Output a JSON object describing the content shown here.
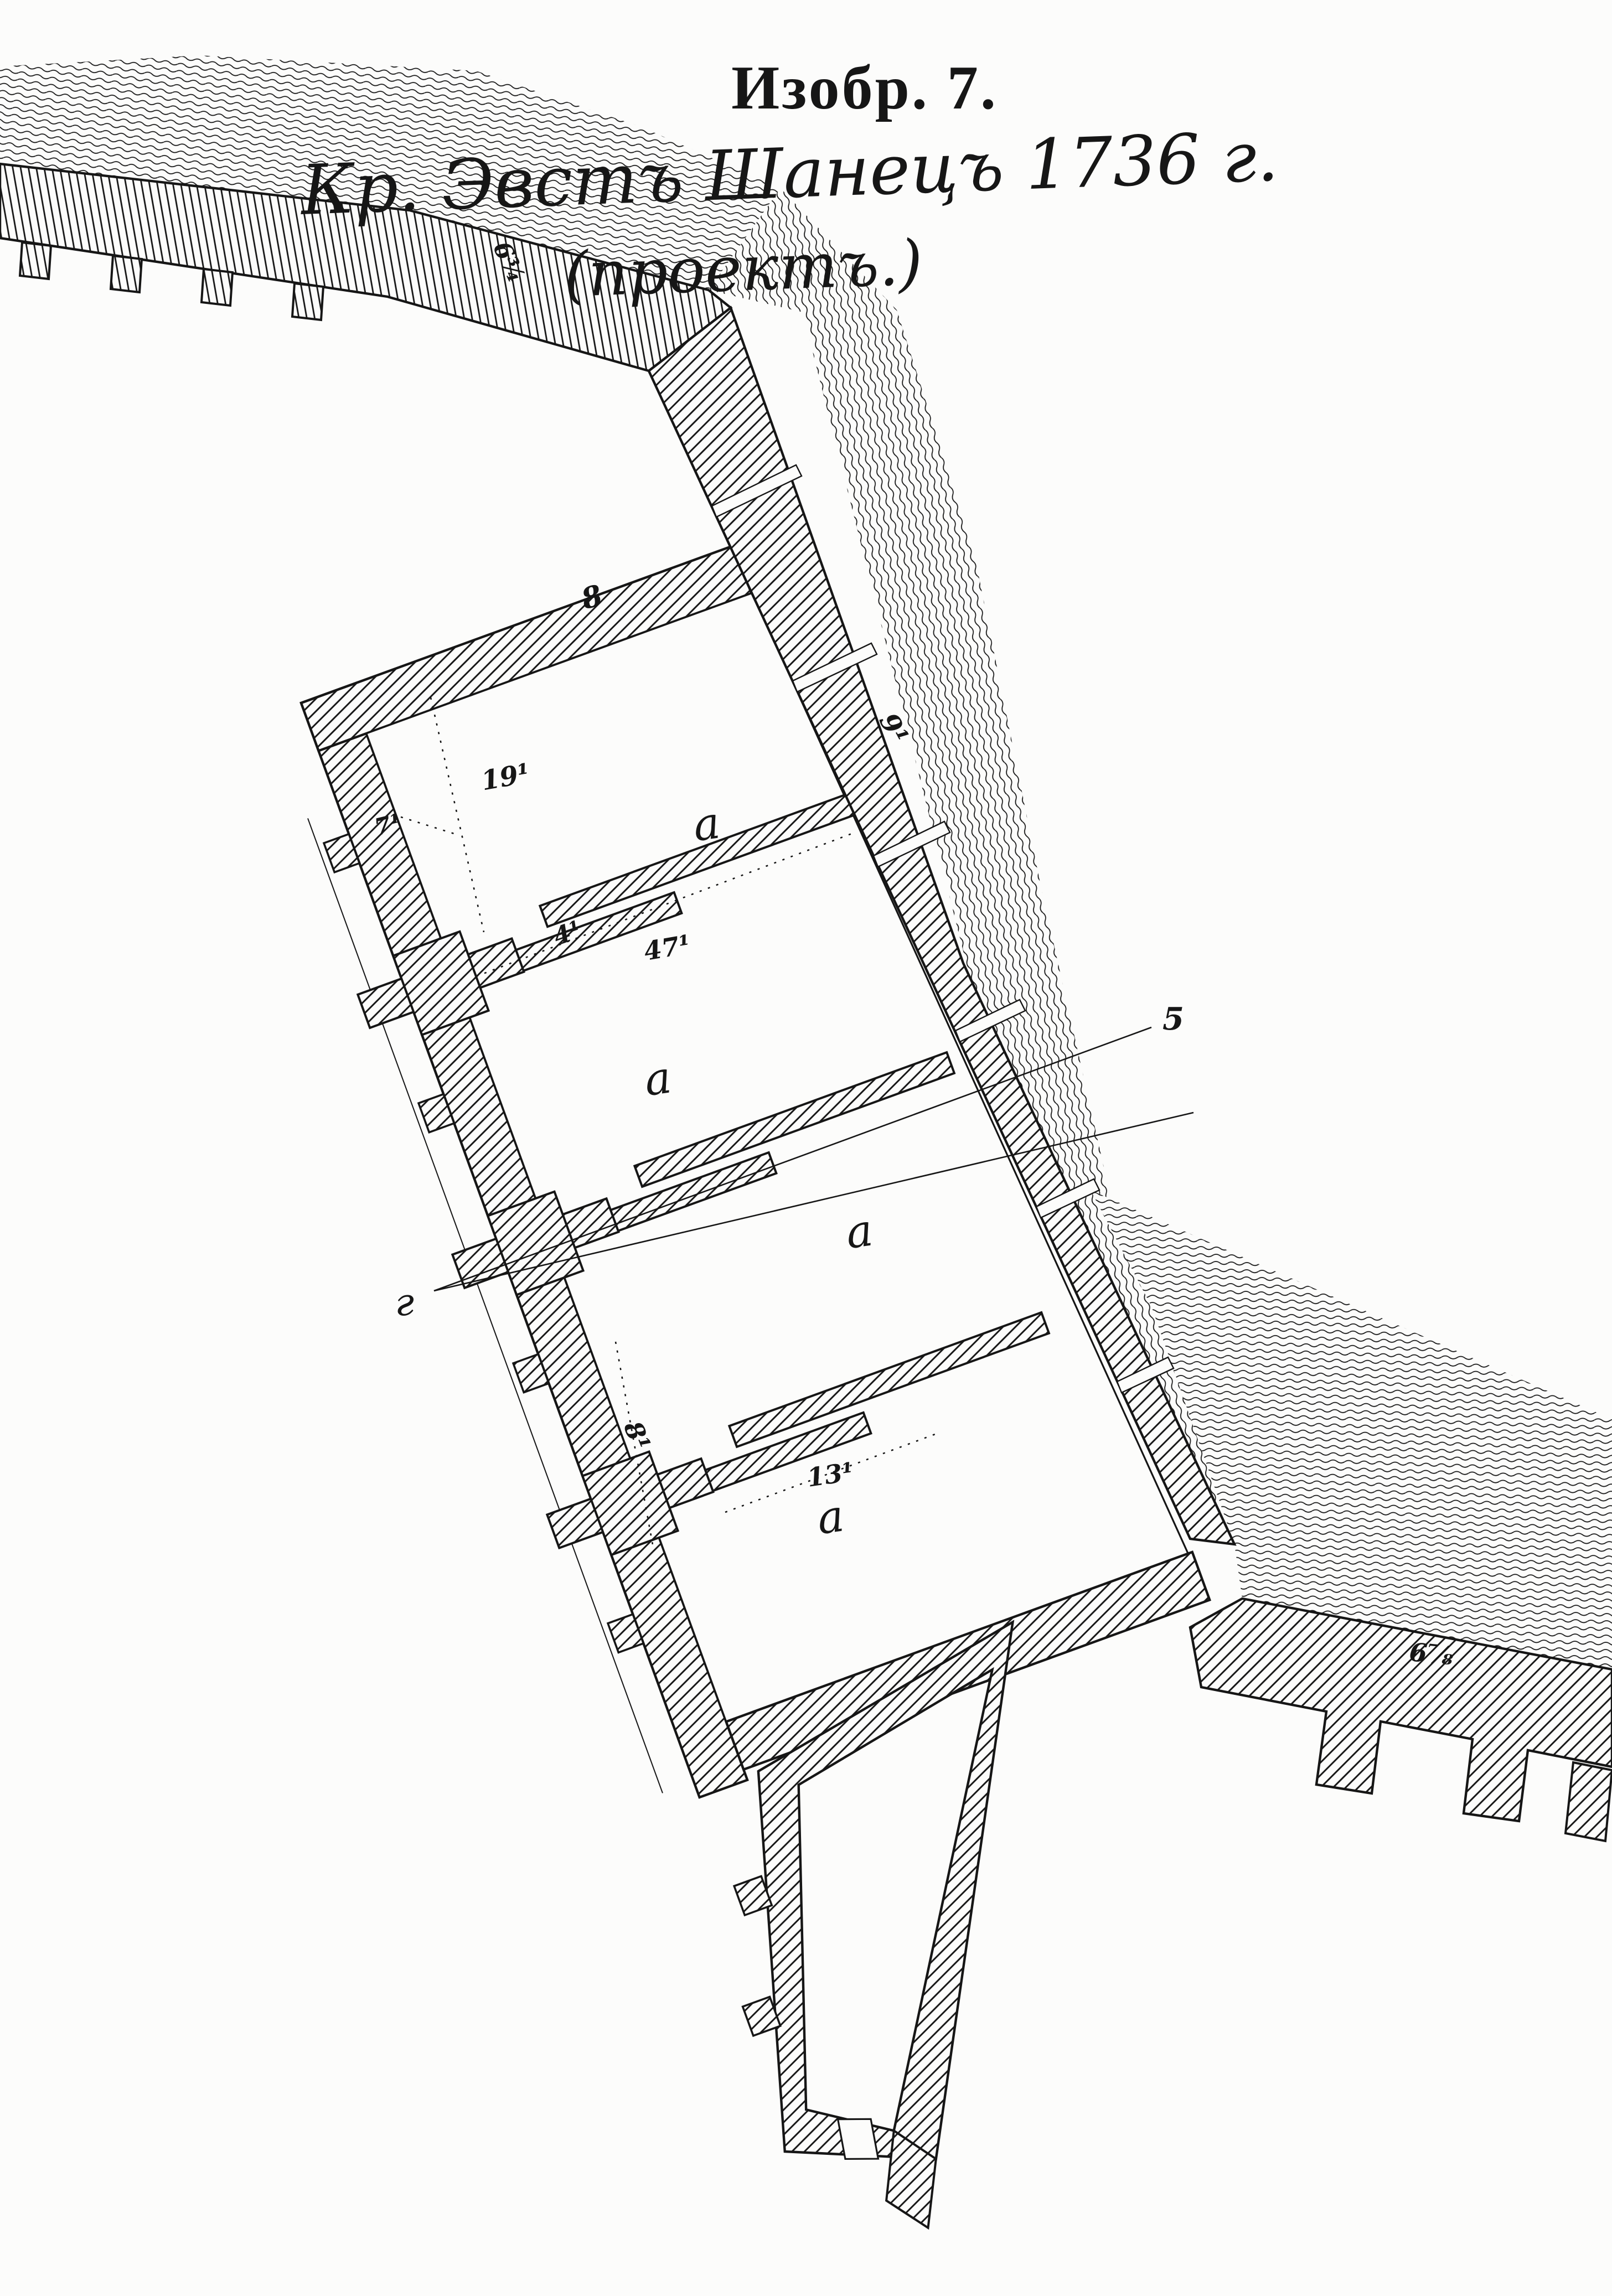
{
  "figure": {
    "caption_line1": "Изобр. 7.",
    "caption_line2": "Кр. Эвстъ Шанецъ 1736 г.",
    "caption_line3": "(проектъ.)"
  },
  "plan": {
    "room_labels": [
      "a",
      "a",
      "a",
      "a"
    ],
    "section_line": {
      "left_marker": "г",
      "right_marker": "5"
    },
    "dimensions": {
      "rampart_nw": "6¾",
      "top_wall": "8",
      "right_rampart": "9¹",
      "room1_width": "19¹",
      "room1_left_gap": "7¹",
      "traverse1": "4¹",
      "room2_diagonal": "47¹",
      "left_rampart_channel": "8¹",
      "traverse3": "13¹",
      "rampart_se": "6⅞"
    }
  },
  "colors": {
    "ink": "#161616",
    "paper": "#fcfcfb"
  }
}
